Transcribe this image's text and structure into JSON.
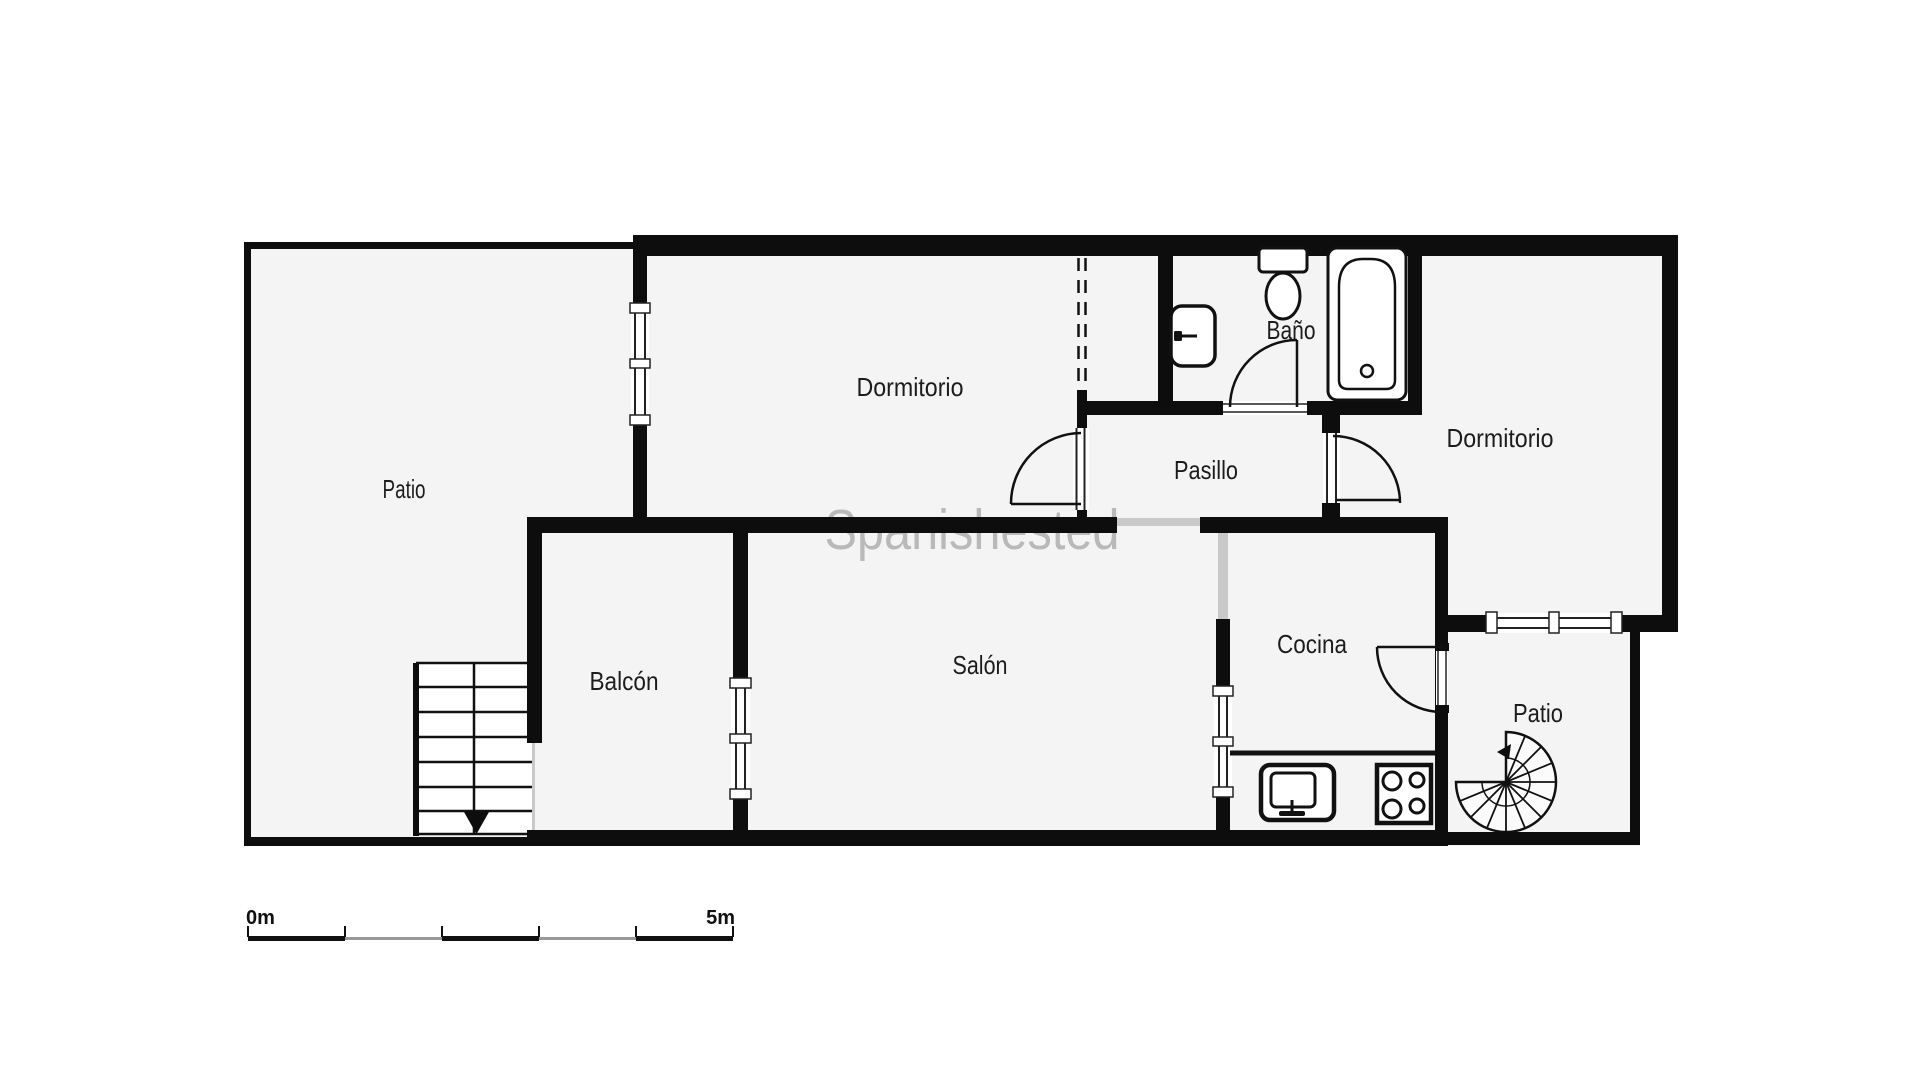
{
  "watermark": {
    "text": "Spanishested"
  },
  "rooms": [
    {
      "id": "patio-left",
      "label": "Patio"
    },
    {
      "id": "dormitorio-top",
      "label": "Dormitorio"
    },
    {
      "id": "bano",
      "label": "Baño"
    },
    {
      "id": "pasillo",
      "label": "Pasillo"
    },
    {
      "id": "dormitorio-right",
      "label": "Dormitorio"
    },
    {
      "id": "balcon",
      "label": "Balcón"
    },
    {
      "id": "salon",
      "label": "Salón"
    },
    {
      "id": "cocina",
      "label": "Cocina"
    },
    {
      "id": "patio-right",
      "label": "Patio"
    }
  ],
  "scale_bar": {
    "start_label": "0m",
    "end_label": "5m"
  },
  "colors": {
    "wall": "#0d0d0d",
    "floor": "#f4f4f4",
    "opening": "#c9c9c9",
    "scale_dark": "#111111",
    "scale_light": "#999999",
    "label_text": "#1c1c1c",
    "watermark_gray": "#7f7f7f"
  }
}
